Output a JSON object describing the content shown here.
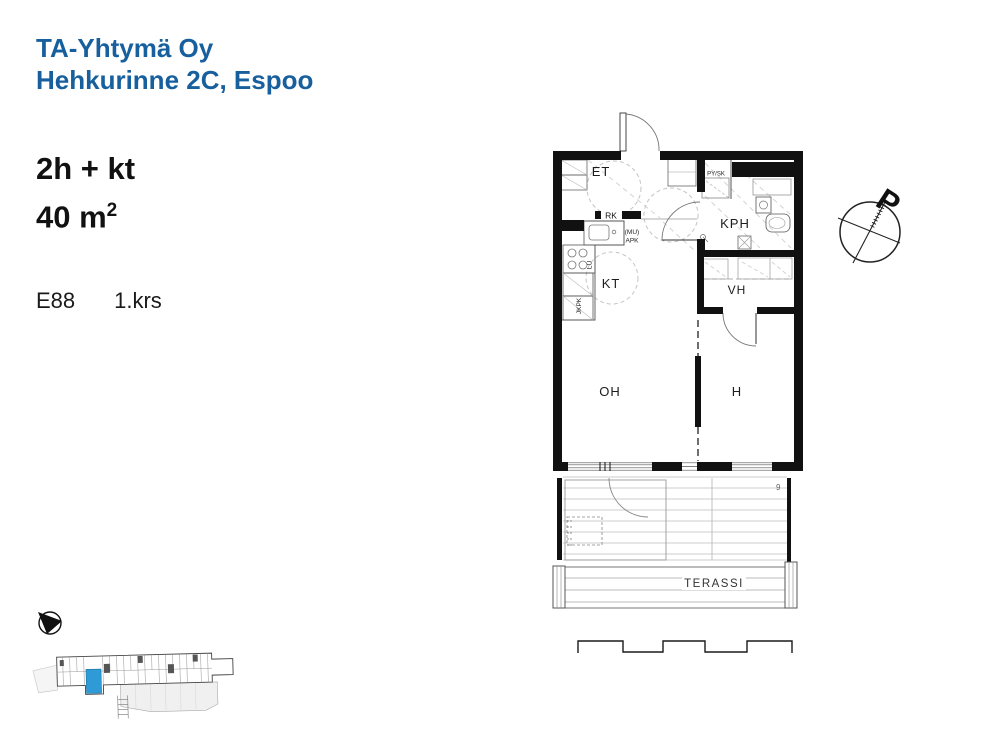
{
  "header": {
    "company": "TA-Yhtymä Oy",
    "address": "Hehkurinne 2C, Espoo"
  },
  "apartment": {
    "layout": "2h + kt",
    "area_base": "40 m",
    "area_sup": "2",
    "unit": "E88",
    "floor": "1.krs"
  },
  "plan": {
    "rooms": {
      "et": "ET",
      "kph": "KPH",
      "kt": "KT",
      "vh": "VH",
      "oh": "OH",
      "h": "H"
    },
    "fixtures": {
      "rk": "RK",
      "mu": "(MU)",
      "apk": "APK",
      "lu": "LU",
      "jkpk": "JKPK",
      "pysk": "PY/SK"
    },
    "terrace_label": "TERASSI",
    "drain_mark": "9",
    "compass_north": "P"
  },
  "colors": {
    "brand_blue": "#175f9d",
    "wall_black": "#111111",
    "unit_highlight": "#2f9bd6"
  }
}
